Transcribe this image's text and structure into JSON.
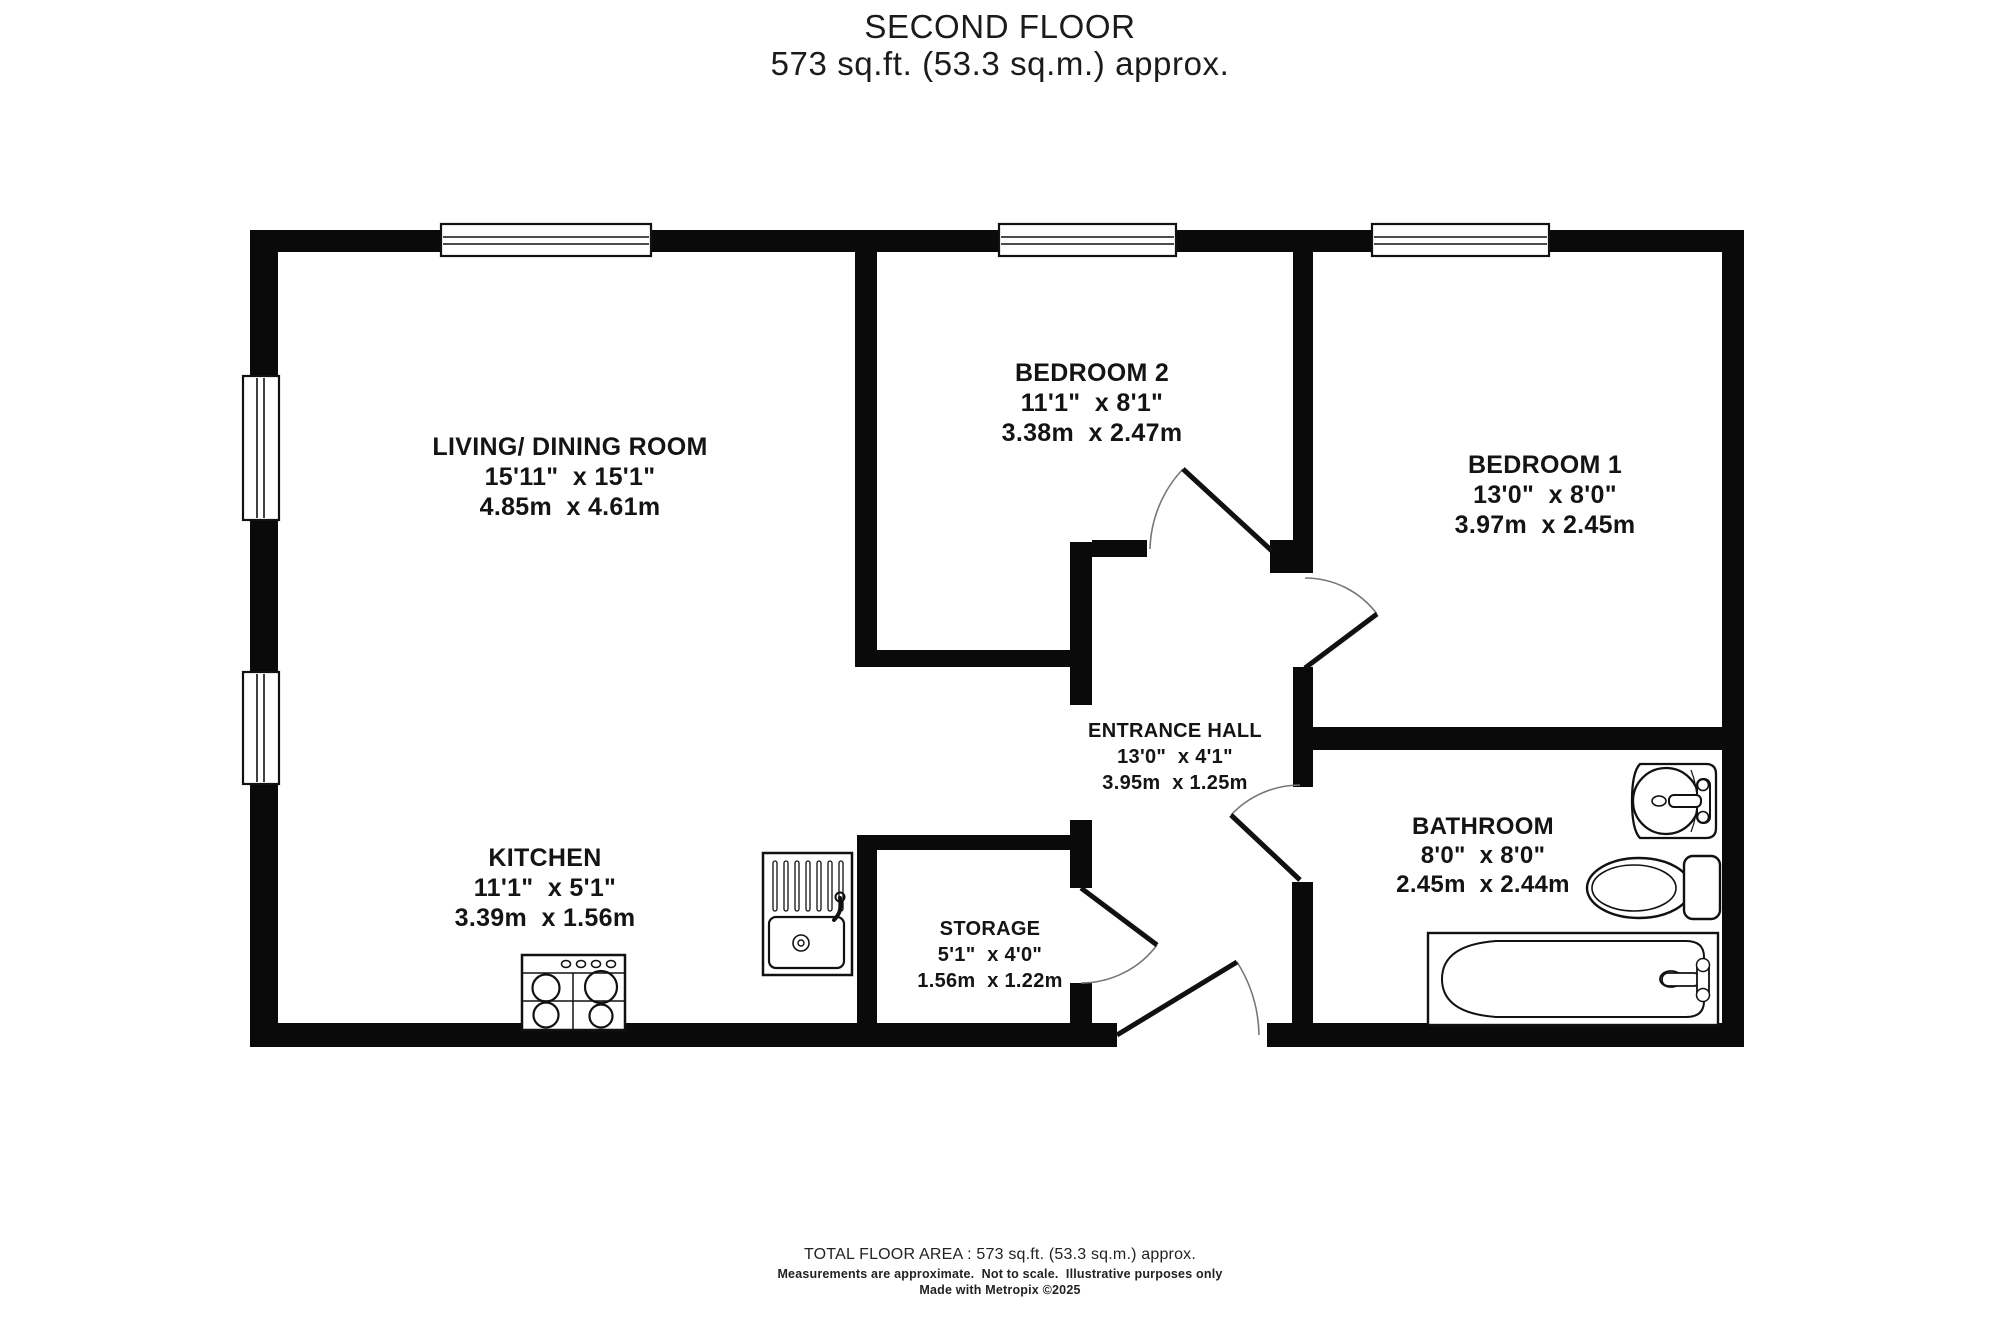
{
  "title": {
    "line1": "SECOND FLOOR",
    "line2": "573 sq.ft. (53.3 sq.m.) approx."
  },
  "rooms": {
    "living": {
      "name": "LIVING/ DINING ROOM",
      "imperial": "15'11\"  x 15'1\"",
      "metric": "4.85m  x 4.61m"
    },
    "bedroom2": {
      "name": "BEDROOM 2",
      "imperial": "11'1\"  x 8'1\"",
      "metric": "3.38m  x 2.47m"
    },
    "bedroom1": {
      "name": "BEDROOM 1",
      "imperial": "13'0\"  x 8'0\"",
      "metric": "3.97m  x 2.45m"
    },
    "entrance_hall": {
      "name": "ENTRANCE HALL",
      "imperial": "13'0\"  x 4'1\"",
      "metric": "3.95m  x 1.25m"
    },
    "kitchen": {
      "name": "KITCHEN",
      "imperial": "11'1\"  x 5'1\"",
      "metric": "3.39m  x 1.56m"
    },
    "storage": {
      "name": "STORAGE",
      "imperial": "5'1\"  x 4'0\"",
      "metric": "1.56m  x 1.22m"
    },
    "bathroom": {
      "name": "BATHROOM",
      "imperial": "8'0\"  x 8'0\"",
      "metric": "2.45m  x 2.44m"
    }
  },
  "footer": {
    "line1": "TOTAL FLOOR AREA : 573 sq.ft. (53.3 sq.m.) approx.",
    "line2": "Measurements are approximate.  Not to scale.  Illustrative purposes only",
    "line3": "Made with Metropix ©2025"
  },
  "colors": {
    "wall": "#0a0a0a",
    "background": "#ffffff",
    "text": "#141414"
  }
}
